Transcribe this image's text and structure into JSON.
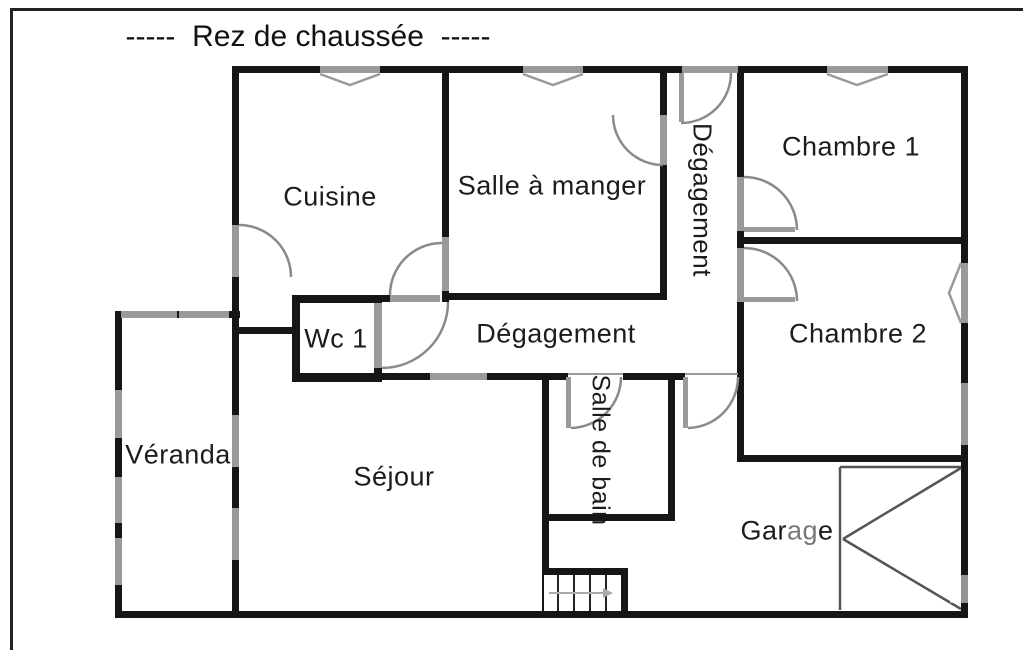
{
  "title": "-----  Rez de chaussée  -----",
  "rooms": [
    {
      "id": "cuisine",
      "label": "Cuisine"
    },
    {
      "id": "salle-a-manger",
      "label": "Salle à manger"
    },
    {
      "id": "degagement-couloir",
      "label": "Dégagement"
    },
    {
      "id": "chambre-1",
      "label": "Chambre 1"
    },
    {
      "id": "chambre-2",
      "label": "Chambre 2"
    },
    {
      "id": "wc-1",
      "label": "Wc 1"
    },
    {
      "id": "degagement",
      "label": "Dégagement"
    },
    {
      "id": "veranda",
      "label": "Véranda"
    },
    {
      "id": "sejour",
      "label": "Séjour"
    },
    {
      "id": "salle-de-bain",
      "label": "Salle de bain"
    },
    {
      "id": "garage",
      "label": "Garage"
    }
  ],
  "symbols": {
    "door_arc": "quarter-circle door swing",
    "window": "gray band / chevron window",
    "garage_door": "rectangle with double diagonal",
    "stairs": "treads with direction arrow"
  },
  "colors": {
    "wall": "#161616",
    "window_gray": "#9a9a9a",
    "door_arc_gray": "#8a8a8a",
    "garage_line": "#555555",
    "background": "#ffffff",
    "text": "#1c1c1c"
  }
}
